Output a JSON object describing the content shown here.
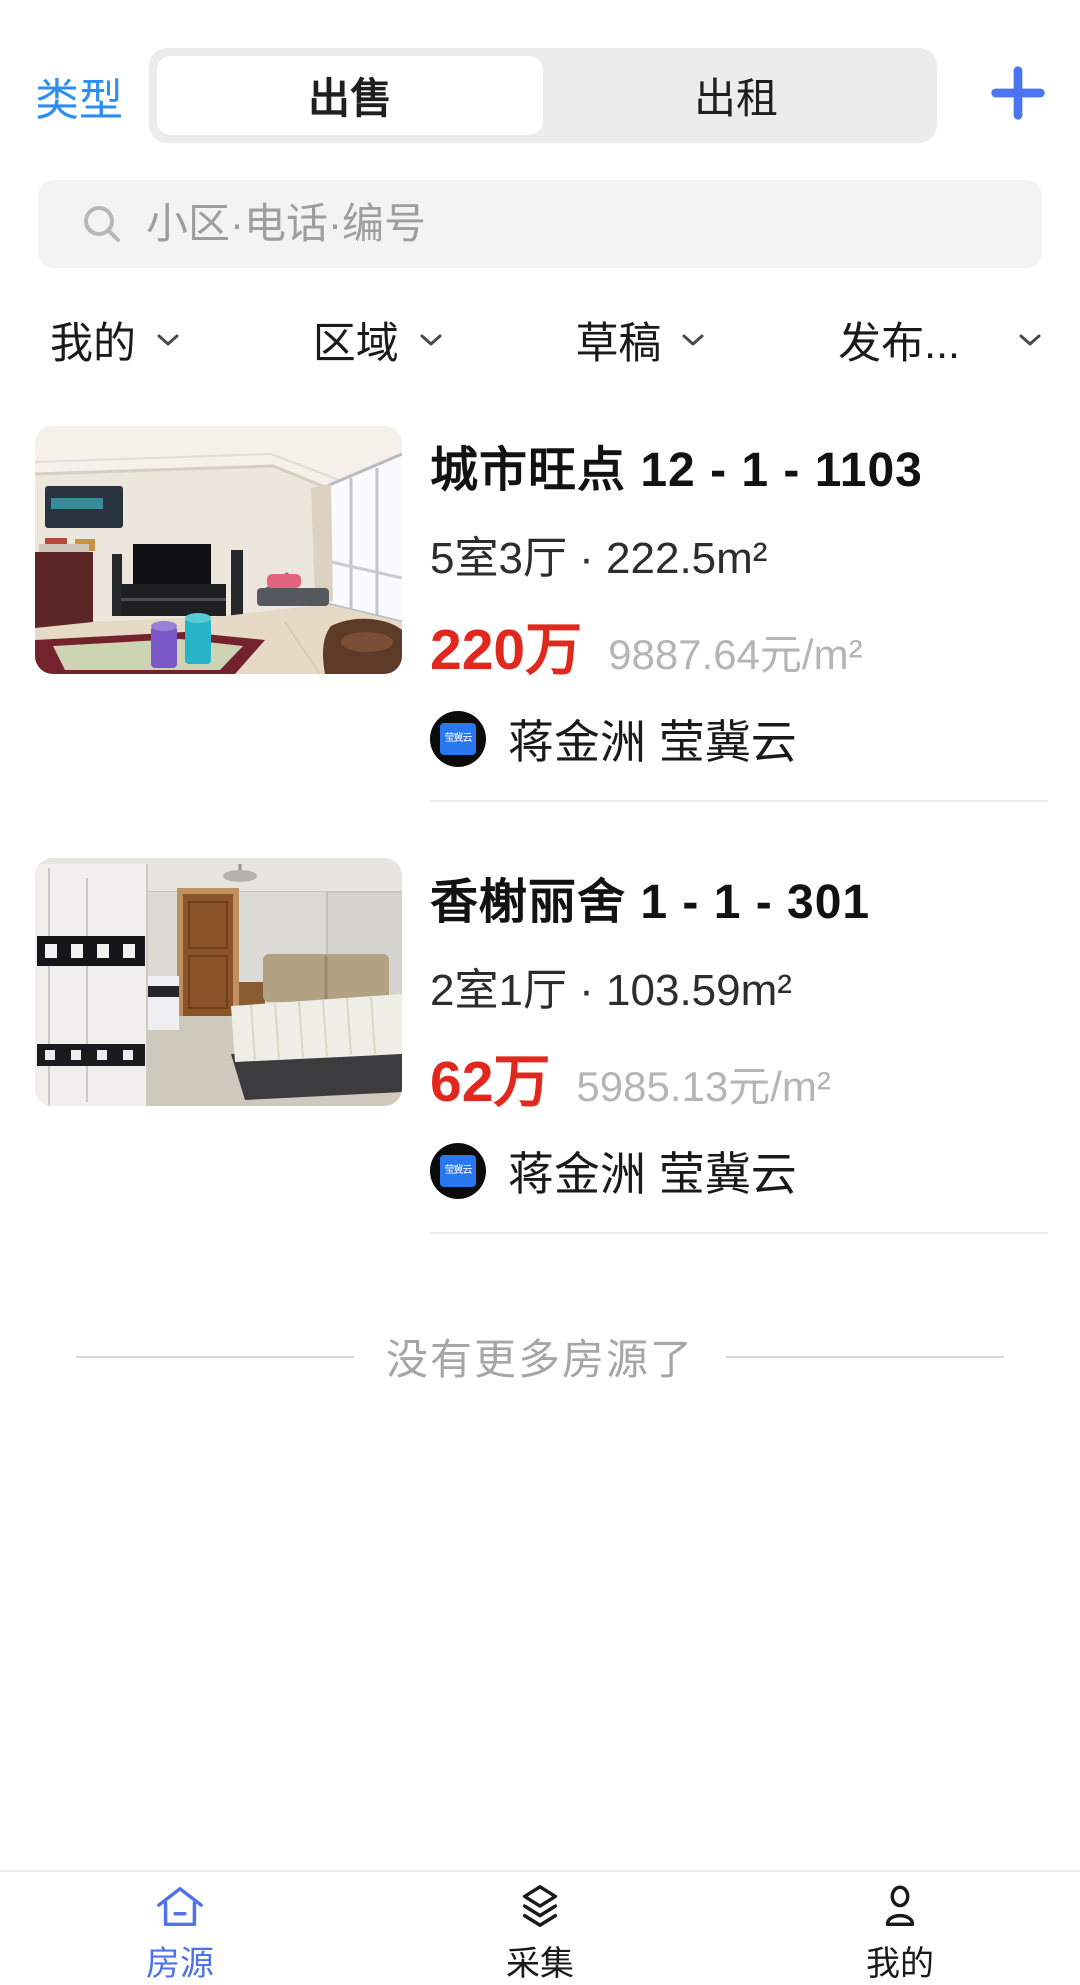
{
  "header": {
    "type_label": "类型",
    "segmented": {
      "selected": "出售",
      "options": [
        {
          "label": "出售"
        },
        {
          "label": "出租"
        }
      ]
    },
    "add_icon": "plus-icon"
  },
  "search": {
    "icon": "search-icon",
    "placeholder": "小区·电话·编号"
  },
  "filters": [
    {
      "label": "我的",
      "icon": "chevron-down-icon"
    },
    {
      "label": "区域",
      "icon": "chevron-down-icon"
    },
    {
      "label": "草稿",
      "icon": "chevron-down-icon"
    },
    {
      "label": "发布...",
      "icon": "chevron-down-icon"
    }
  ],
  "listings": [
    {
      "title": "城市旺点 12 - 1 - 1103",
      "spec": "5室3厅 · 222.5m²",
      "price": "220万",
      "unit_price": "9887.64元/m²",
      "agent_badge": "莹冀云",
      "agent_name": "蒋金洲 莹冀云",
      "photo": "living-room-photo"
    },
    {
      "title": "香榭丽舍 1 - 1 - 301",
      "spec": "2室1厅 · 103.59m²",
      "price": "62万",
      "unit_price": "5985.13元/m²",
      "agent_badge": "莹冀云",
      "agent_name": "蒋金洲 莹冀云",
      "photo": "bedroom-photo"
    }
  ],
  "list_end_text": "没有更多房源了",
  "tabbar": [
    {
      "label": "房源",
      "icon": "home-icon",
      "active": true
    },
    {
      "label": "采集",
      "icon": "layers-icon",
      "active": false
    },
    {
      "label": "我的",
      "icon": "user-icon",
      "active": false
    }
  ],
  "colors": {
    "link_blue": "#2E8EF0",
    "primary_blue": "#4F73EA",
    "price_red": "#E2281E",
    "unit_gray": "#B5B5B5",
    "segmented_bg": "#ECECEC",
    "search_bg": "#F3F3F3"
  }
}
